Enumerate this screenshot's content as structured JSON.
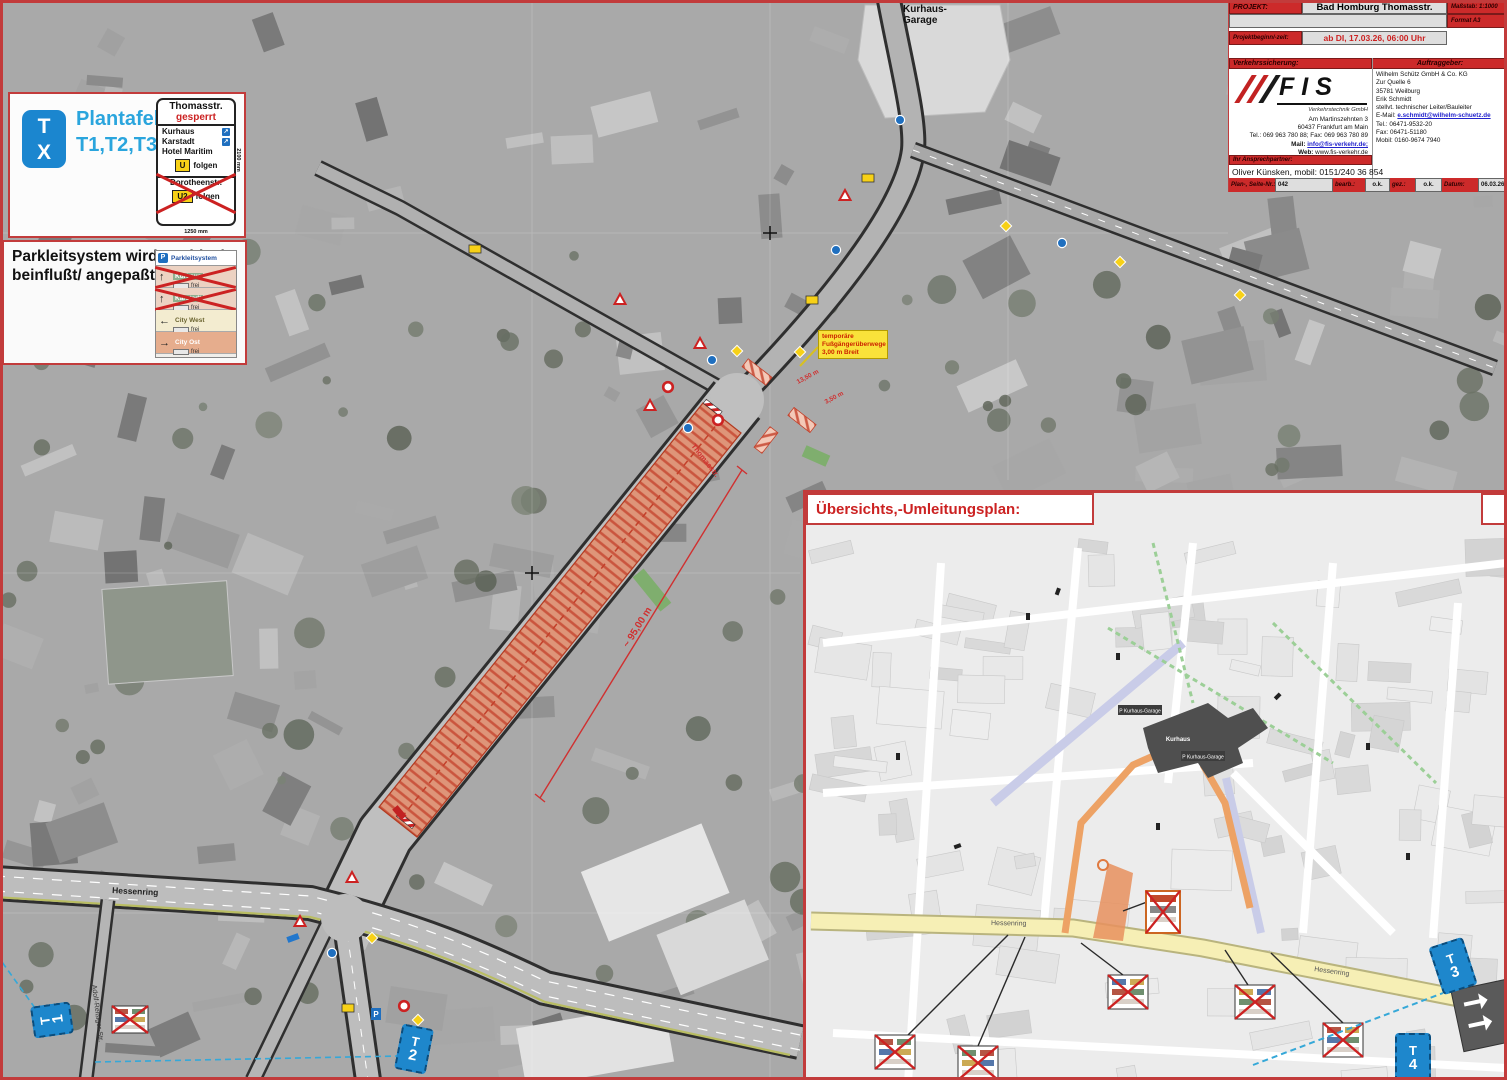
{
  "title_block": {
    "project_label": "PROJEKT:",
    "project_value": "Bad Homburg Thomasstr.",
    "scale_label": "Maßstab:",
    "scale_value": "1:1000",
    "format_value": "Format A3",
    "begin_label": "Projektbeginn/-zeit:",
    "begin_value": "ab DI, 17.03.26, 06:00 Uhr",
    "sicherung_label": "Verkehrssicherung:",
    "auftraggeber_label": "Auftraggeber:",
    "fis_logo": "FIS",
    "fis_sub": "Verkehrstechnik GmbH",
    "fis_addr1": "Am Martinszehnten 3",
    "fis_addr2": "60437 Frankfurt am Main",
    "fis_tel": "Tel.: 069 963 780 88; Fax: 069 963 780 89",
    "fis_mail_label": "Mail: ",
    "fis_mail": "info@fis-verkehr.de;",
    "fis_web_label": "Web: ",
    "fis_web": "www.fis-verkehr.de",
    "client_name": "Wilhelm Schütz GmbH & Co. KG",
    "client_street": "Zur Quelle 6",
    "client_city": "35781 Weilburg",
    "client_contact": "Erik Schmidt",
    "client_role": "stellvt. technischer Leiter/Bauleiter",
    "client_email_label": "E-Mail: ",
    "client_email": "e.schmidt@wilhelm-schuetz.de",
    "client_tel_label": "Tel.: ",
    "client_tel": "06471-9532-20",
    "client_fax_label": "Fax: ",
    "client_fax": "06471-51180",
    "client_mobil_label": "Mobil: ",
    "client_mobil": "0160-9674 7940",
    "partner_label": "Ihr Ansprechpartner:",
    "partner_value": "Oliver Künsken, mobil: 0151/240 36 854",
    "footer_plan_label": "Plan-, Seite-Nr.:",
    "footer_plan_value": "042",
    "footer_bearb_label": "bearb.:",
    "footer_bearb_value": "o.k.",
    "footer_gez_label": "gez.:",
    "footer_gez_value": "o.k.",
    "footer_datum_label": "Datum:",
    "footer_datum_value": "06.03.26"
  },
  "plantafel": {
    "badge_top": "T",
    "badge_bottom": "X",
    "title": "Plantafel:",
    "subtitle": "T1,T2,T3,T4"
  },
  "sperr_sign": {
    "street": "Thomasstr.",
    "status": "gesperrt",
    "dest1": "Kurhaus",
    "dest2": "Karstadt",
    "dest3": "Hotel Maritim",
    "u_badge": "U",
    "u_folgen": "folgen",
    "crossed_street": "Dorotheenstr.",
    "u2_badge": "U2",
    "u2_folgen": "folgen",
    "dim_width": "1250 mm",
    "dim_height": "2100 mm"
  },
  "parkleit": {
    "note_line1": "Parkleitsystem wird städtisch",
    "note_line2": "beinflußt/ angepaßt",
    "sign_header": "Parkleitsystem",
    "p_badge": "P",
    "rows": [
      {
        "arrow": "↑",
        "name": "Kurhaus",
        "status": "frei",
        "crossed": true
      },
      {
        "arrow": "↑",
        "name": "Karstadt",
        "status": "frei",
        "crossed": true
      },
      {
        "arrow": "←",
        "name": "City West",
        "status": "frei",
        "crossed": false
      },
      {
        "arrow": "→",
        "name": "City Ost",
        "status": "frei",
        "crossed": false
      }
    ]
  },
  "icons": {
    "direction-arrow": "↗",
    "parking-p": "P"
  },
  "map": {
    "kurhaus_garage_line1": "Kurhaus-",
    "kurhaus_garage_line2": "Garage",
    "hessenring": "Hessenring",
    "adolf": "Adolf-Reißiger-Str.",
    "thomasstr": "Thomasstr.",
    "dim_95": "~ 95,00 m",
    "dim_13": "13,50 m",
    "dim_35": "3,50 m",
    "note_line1": "temporäre",
    "note_line2": "Fußgängerüberwege",
    "note_line3": "3,00 m Breit"
  },
  "t_markers": [
    {
      "letter": "T",
      "number": "1"
    },
    {
      "letter": "T",
      "number": "2"
    },
    {
      "letter": "T",
      "number": "3"
    },
    {
      "letter": "T",
      "number": "4"
    }
  ],
  "inset": {
    "title": "Übersichts,-Umleitungsplan:",
    "hessenring": "Hessenring",
    "kurhaus": "Kurhaus",
    "garage": "P Kurhaus-Garage"
  },
  "colors": {
    "sheet_red": "#c23b3b",
    "construction_fill": "#e2906f",
    "construction_hatch": "#c3402a",
    "marker_blue": "#1e87cc",
    "legend_cyan": "#2aa5dd",
    "sign_yellow": "#f7d117",
    "route_orange": "#eda265",
    "road_yellow": "#f6efb5",
    "detour_green": "#9ccf97",
    "closed_lavender": "#c9cce8"
  }
}
